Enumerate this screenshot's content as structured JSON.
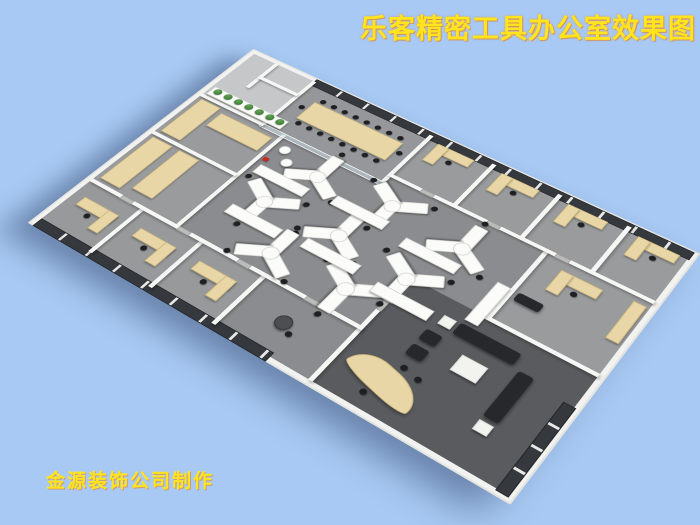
{
  "title": {
    "text": "乐客精密工具办公室效果图"
  },
  "credit": {
    "text": "金源装饰公司制作"
  },
  "scene": {
    "colors": {
      "bg": "#a7c9f3",
      "slab": "#f2f2f0",
      "wall": "#f6f6f4",
      "floorOpen": "#8b8c8f",
      "floorRoom": "#9a9b9d",
      "floorLight": "#c6c7c9",
      "floorConf": "#96979a",
      "floorExec": "#595b5e",
      "floorBottom": "#98999b",
      "window": "#35383c",
      "frame": "#e8e8e6",
      "wood": "#e8d6a6",
      "woodDark": "#cdb87f",
      "whiteDesk": "#fbfbfa",
      "chair": "#1e2022",
      "sofa": "#26282b",
      "plant": "#3e7c3a",
      "glass": "rgba(198,219,228,0.55)",
      "door": "#bcbcba",
      "accentRed": "#cc2a1e",
      "title": "#ffe41e",
      "titleGlow": "rgba(233,118,18,0.55)",
      "shadow": "rgba(45,65,105,0.5)"
    },
    "workstation_count": 8,
    "perimeter_office_windows": "dark-glass-strips"
  }
}
